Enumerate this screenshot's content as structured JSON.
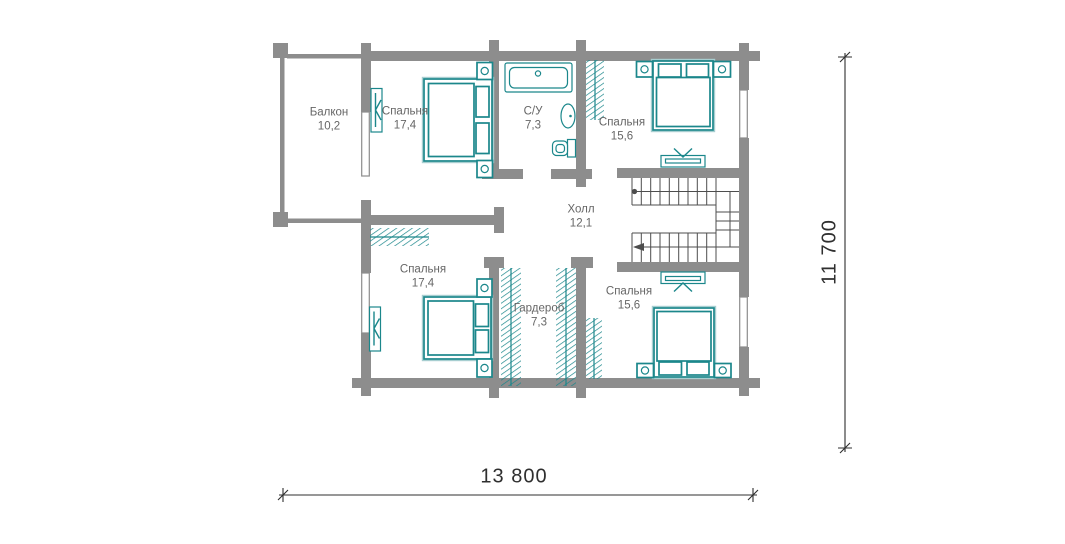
{
  "title": "Floor plan — second floor",
  "rooms": [
    {
      "id": "balcony",
      "name": "Балкон",
      "area": "10,2"
    },
    {
      "id": "bedroom-top-left",
      "name": "Спальня",
      "area": "17,4"
    },
    {
      "id": "bathroom",
      "name": "С/У",
      "area": "7,3"
    },
    {
      "id": "bedroom-top-right",
      "name": "Спальня",
      "area": "15,6"
    },
    {
      "id": "hall",
      "name": "Холл",
      "area": "12,1"
    },
    {
      "id": "bedroom-bottom-left",
      "name": "Спальня",
      "area": "17,4"
    },
    {
      "id": "wardrobe",
      "name": "Гардероб",
      "area": "7,3"
    },
    {
      "id": "bedroom-bottom-right",
      "name": "Спальня",
      "area": "15,6"
    }
  ],
  "dimensions": {
    "width_label": "13 800",
    "height_label": "11 700"
  },
  "colors": {
    "wall": "#8d8d8d",
    "teal": "#1b878b",
    "teal_light": "#a7ced0",
    "label": "#666666",
    "dim": "#2f2f2f",
    "line": "#4d4d4d"
  }
}
